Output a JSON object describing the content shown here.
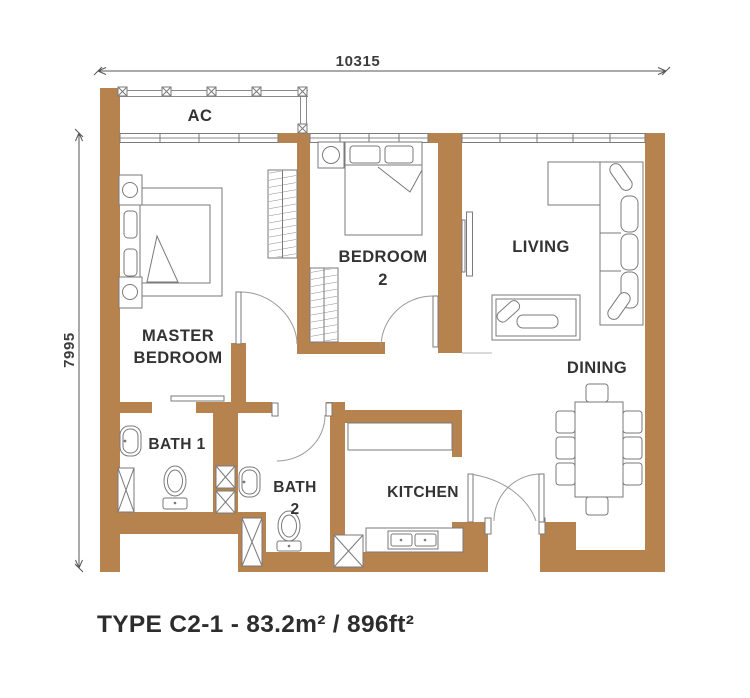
{
  "title": "TYPE C2-1 - 83.2m² / 896ft²",
  "dimensions": {
    "top": "10315",
    "left": "7995"
  },
  "rooms": {
    "ac": "AC",
    "master_bedroom": {
      "line1": "MASTER",
      "line2": "BEDROOM"
    },
    "bedroom2": {
      "line1": "BEDROOM",
      "line2": "2"
    },
    "living": "LIVING",
    "dining": "DINING",
    "bath1": "BATH 1",
    "bath2": {
      "line1": "BATH",
      "line2": "2"
    },
    "kitchen": "KITCHEN"
  },
  "colors": {
    "wall": "#b6824d",
    "line": "#7a7a7a",
    "text": "#333333",
    "background": "#ffffff"
  }
}
